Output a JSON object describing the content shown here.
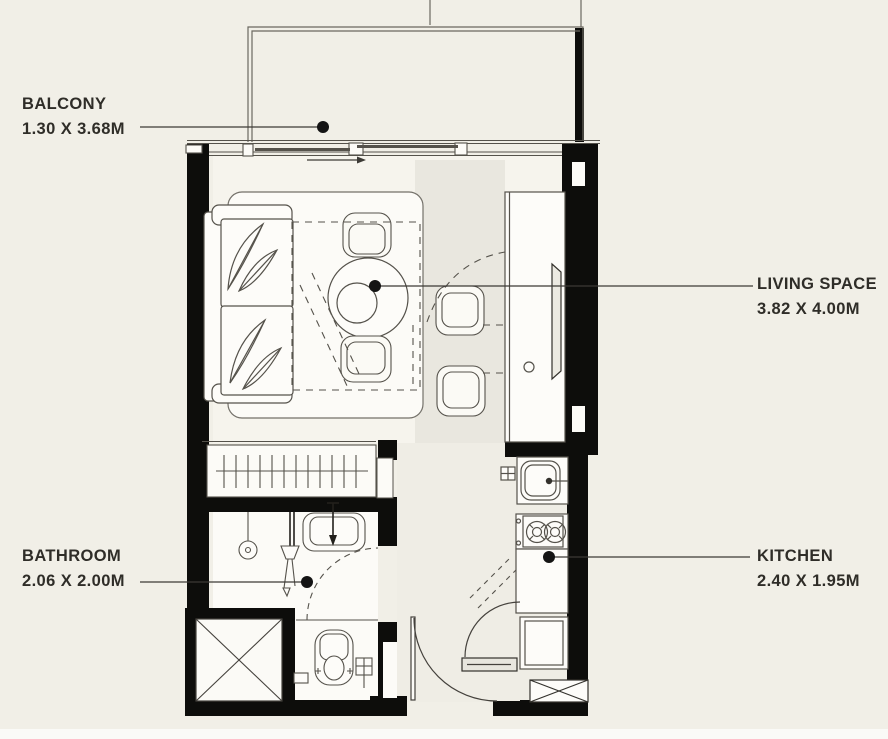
{
  "floorplan": {
    "type": "apartment-floor-plan",
    "rooms": [
      {
        "id": "balcony",
        "label": "BALCONY",
        "dimensions": "1.30 X 3.68M"
      },
      {
        "id": "living-space",
        "label": "LIVING SPACE",
        "dimensions": "3.82 X 4.00M"
      },
      {
        "id": "bathroom",
        "label": "BATHROOM",
        "dimensions": "2.06 X 2.00M"
      },
      {
        "id": "kitchen",
        "label": "KITCHEN",
        "dimensions": "2.40 X 1.95M"
      }
    ],
    "colors": {
      "background": "#f1efe7",
      "wall": "#0d0d0b",
      "line": "#55524b",
      "text": "#2f2d28",
      "leader_dot": "#141414",
      "floor_light": "#f6f4ed",
      "floor_gray": "#e9e7df",
      "floor_white": "#fcfbf7"
    }
  }
}
